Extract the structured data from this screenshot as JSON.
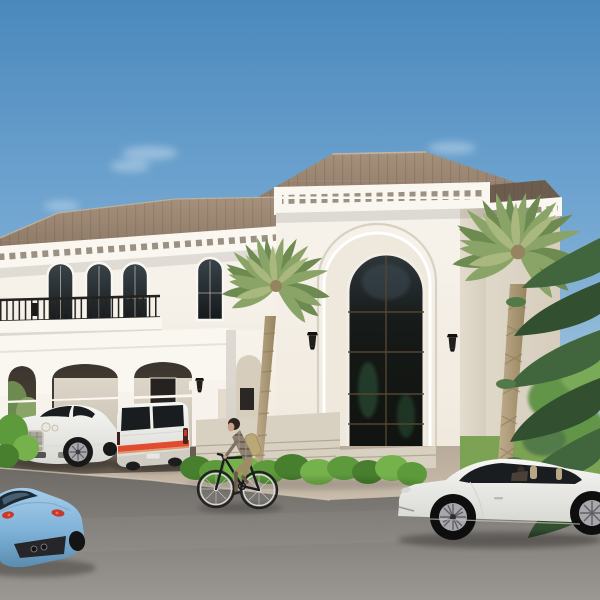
{
  "scene": {
    "description": "3D architectural rendering of a two-story white classical villa with a tall arched glass entry, dentil cornices, arched windows, balcony, carport with a white luxury sedan and a white minivan with red stripe, palm trees and hedges, a cyclist riding past, a light blue sports car at lower left and a white sports coupe at lower right under a clear blue sky.",
    "objects": [
      "white-classical-villa",
      "entry-tower-arched-glass",
      "left-wing-balcony",
      "carport",
      "luxury-sedan-white",
      "minivan-white-red-stripe",
      "sports-car-blue",
      "sports-coupe-white",
      "cyclist",
      "palm-tree-left",
      "palm-tree-right",
      "conifer-tree",
      "leafy-tree",
      "hedge-row",
      "driveway",
      "asphalt-road",
      "blue-sky"
    ]
  },
  "palette": {
    "sky_top": "#4a88bc",
    "sky_mid": "#74a8d2",
    "sky_low": "#a9cade",
    "sky_horizon": "#c6dbe9",
    "wall_white": "#f7f3ec",
    "wall_cream": "#efe8dc",
    "wall_shadow": "#e3dccd",
    "wall_dark": "#d6cdbd",
    "cornice_white": "#faf7f1",
    "dentil_shadow": "#9a9183",
    "roof_light": "#a6917b",
    "roof_mid": "#8b7866",
    "roof_dark": "#6d5d4e",
    "roof_edge": "#c4b49e",
    "glass_top": "#39444a",
    "glass_dark": "#14181a",
    "glass_green": "#2f5a3c",
    "frame_bronze": "#54452f",
    "railing_dark": "#23221f",
    "trunk_light": "#c2af8e",
    "trunk_dark": "#96835f",
    "leaf_light": "#a8b87f",
    "leaf_mid": "#8aa468",
    "leaf_dark": "#6d8a50",
    "conifer_dark": "#324f30",
    "conifer_mid": "#41653c",
    "conifer_light": "#527a48",
    "tree_light": "#79aa58",
    "tree_mid": "#639548",
    "lawn_green": "#7ca353",
    "bush_light": "#76b24c",
    "bush_mid": "#5c9a3c",
    "bush_dark": "#477f2e",
    "apron_tan": "#b9ab9a",
    "apron_light": "#cdc1b0",
    "carport_floor": "#675d52",
    "steps_concrete": "#d8d1c2",
    "step_line": "#b2a995",
    "road_top": "#6e6a65",
    "road_bottom": "#9b9792",
    "curb": "#cfc6b4",
    "car_white": "#f6f6f4",
    "car_white_shadow": "#d8d8d3",
    "car_glass": "#1a1d20",
    "blue_light": "#a5cdea",
    "blue_mid": "#7fb2d8",
    "blue_dark": "#5a8cb0",
    "stripe_red": "#e14b30",
    "tail_red": "#c43a2e",
    "chrome": "#c9c5ba",
    "grille_dark": "#6e6b62",
    "tire_black": "#181818",
    "alloy": "#a8a8ac",
    "alloy_dark": "#5f5f64",
    "skin_tan": "#c9a184",
    "hair_dark": "#2c241e",
    "shirt_base": "#8d8070",
    "shirt_line": "#675c4e",
    "shorts_khaki": "#a08b66",
    "backpack_tan": "#bba877"
  }
}
